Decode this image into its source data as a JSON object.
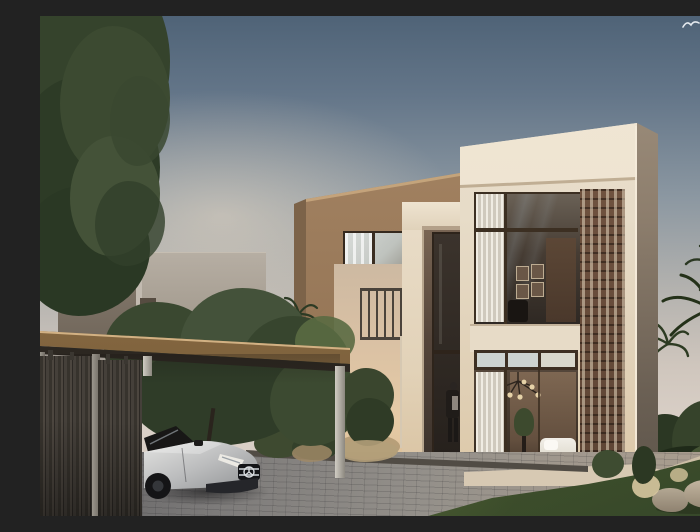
{
  "scene": {
    "title": "Dusk architectural rendering of a modern two-storey villa with carport, silver sedan, palms and lawn",
    "type": "architectural exterior rendering",
    "time_of_day": "dusk",
    "sky": {
      "top_color": "#4f6377",
      "horizon_color": "#d9cec5",
      "bird": "distant gull silhouette"
    },
    "main_house": {
      "style": "modern flat-roof villa, two storeys",
      "facade_color": "#e8ddc9",
      "accent_volume_color": "#9c7c5c",
      "screen_color": "#6b4d3b",
      "window_frame_color": "#3c2f22",
      "features": [
        "double-height glazed facade",
        "perforated brick mashrabiya screen",
        "recessed entry with tall glass door",
        "projecting tan stucco volume with picture window",
        "roof parapet"
      ]
    },
    "interior": {
      "upper_floor": [
        "white curtains",
        "gallery of small picture frames",
        "dark armchair"
      ],
      "ground_floor": [
        "sputnik chandelier",
        "potted plant on stand",
        "white bed",
        "white curtains",
        "bright transom panes"
      ]
    },
    "entrance": {
      "person": "figure standing at the glass entry door"
    },
    "carport": {
      "roof": "flat timber canopy",
      "roof_color": "#8f6f45",
      "posts": "slim light-grey steel posts",
      "fence": "dark vertical timber slat screen",
      "fence_color": "#45403a",
      "car": {
        "body_style": "luxury sedan, front three-quarter view",
        "color": "silver",
        "emblem": "three-pointed star in grille"
      }
    },
    "neighbor_house": {
      "left_block_color": "#8d8174",
      "right_block_color": "#b6aea3"
    },
    "landscape": {
      "left": "large dark-green tree over boundary",
      "middle": "garden trees behind carport, shrubs and grasses in planting bed",
      "right": [
        "palm trees",
        "dense dark shrubs",
        "stone path",
        "lawn",
        "boulders",
        "pale grass tufts"
      ],
      "ground": [
        "grey paver driveway",
        "dark stone curb",
        "warm stone plinth"
      ]
    }
  }
}
